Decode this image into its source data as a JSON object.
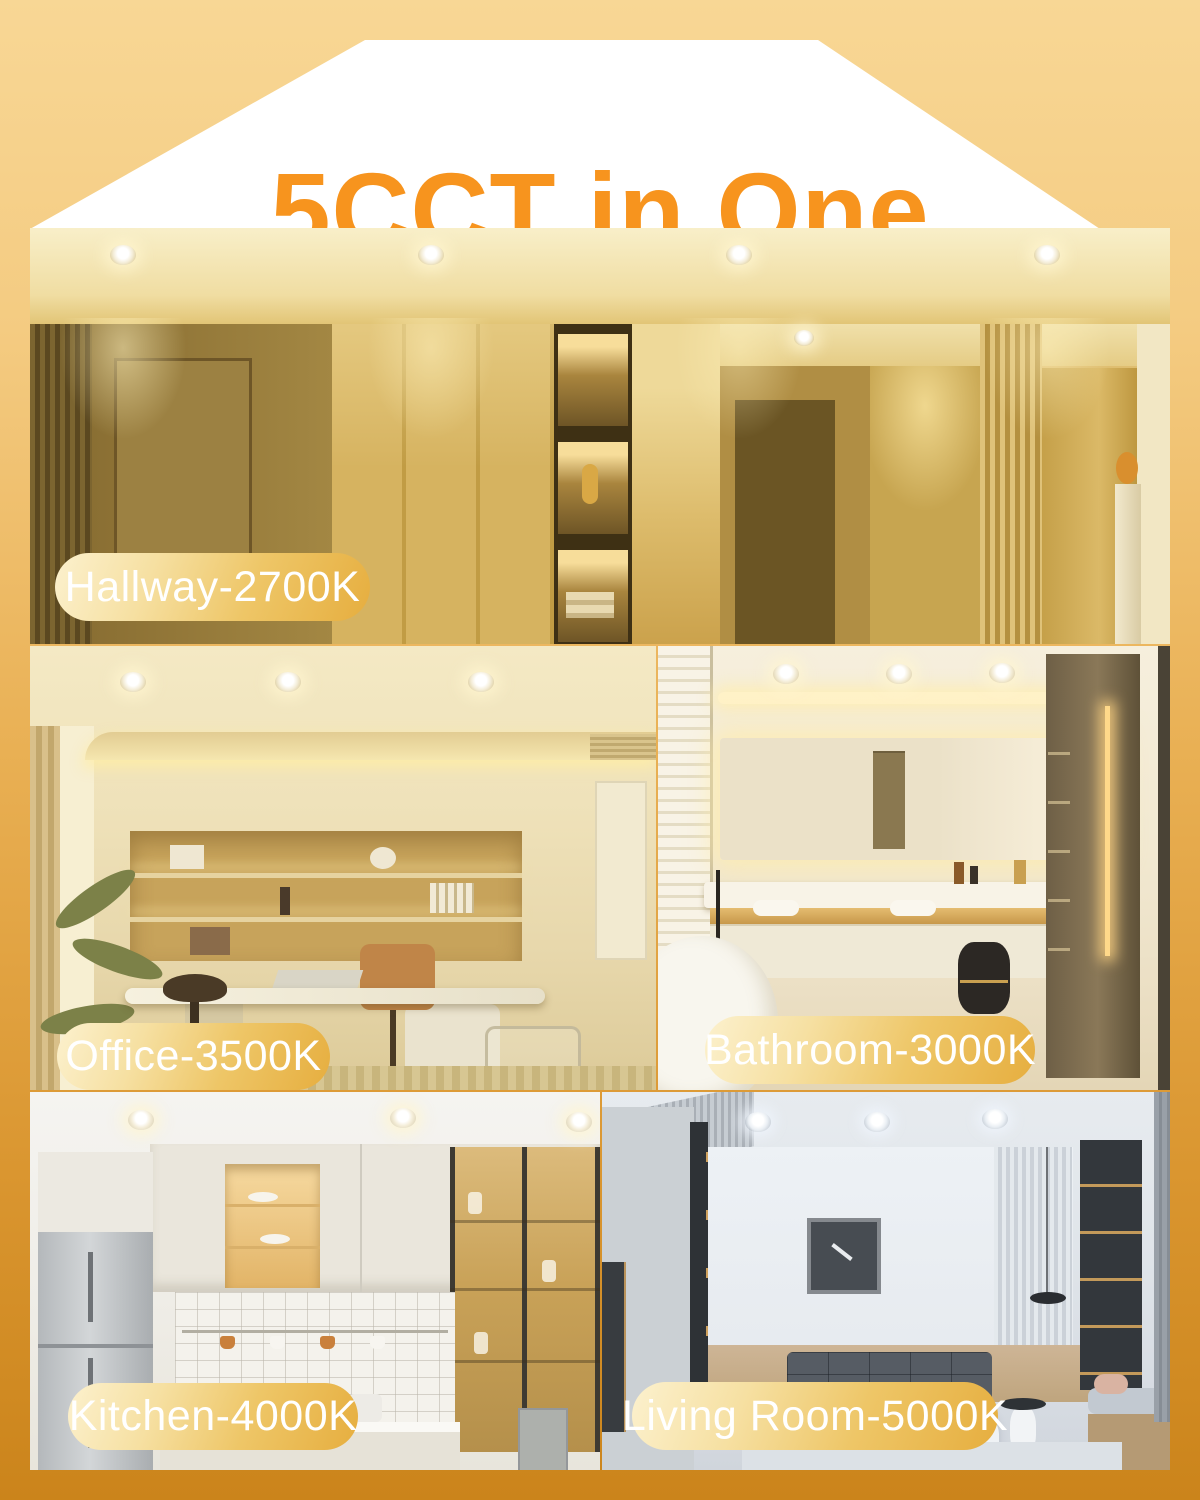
{
  "header": {
    "title": "5CCT in One"
  },
  "rooms": [
    {
      "room": "Hallway",
      "cct": "2700K",
      "label": "Hallway-2700K"
    },
    {
      "room": "Office",
      "cct": "3500K",
      "label": "Office-3500K"
    },
    {
      "room": "Bathroom",
      "cct": "3000K",
      "label": "Bathroom-3000K"
    },
    {
      "room": "Kitchen",
      "cct": "4000K",
      "label": "Kitchen-4000K"
    },
    {
      "room": "Living Room",
      "cct": "5000K",
      "label": "Living Room-5000K"
    }
  ],
  "colors": {
    "accent_orange": "#F7941E",
    "background_top": "#F8D795",
    "background_bottom": "#CB841B",
    "banner": "#FFFFFF",
    "label_pill_light": "#FCF1CE",
    "label_pill_gold": "#E6AE3F",
    "label_text": "#FFFFFF"
  }
}
